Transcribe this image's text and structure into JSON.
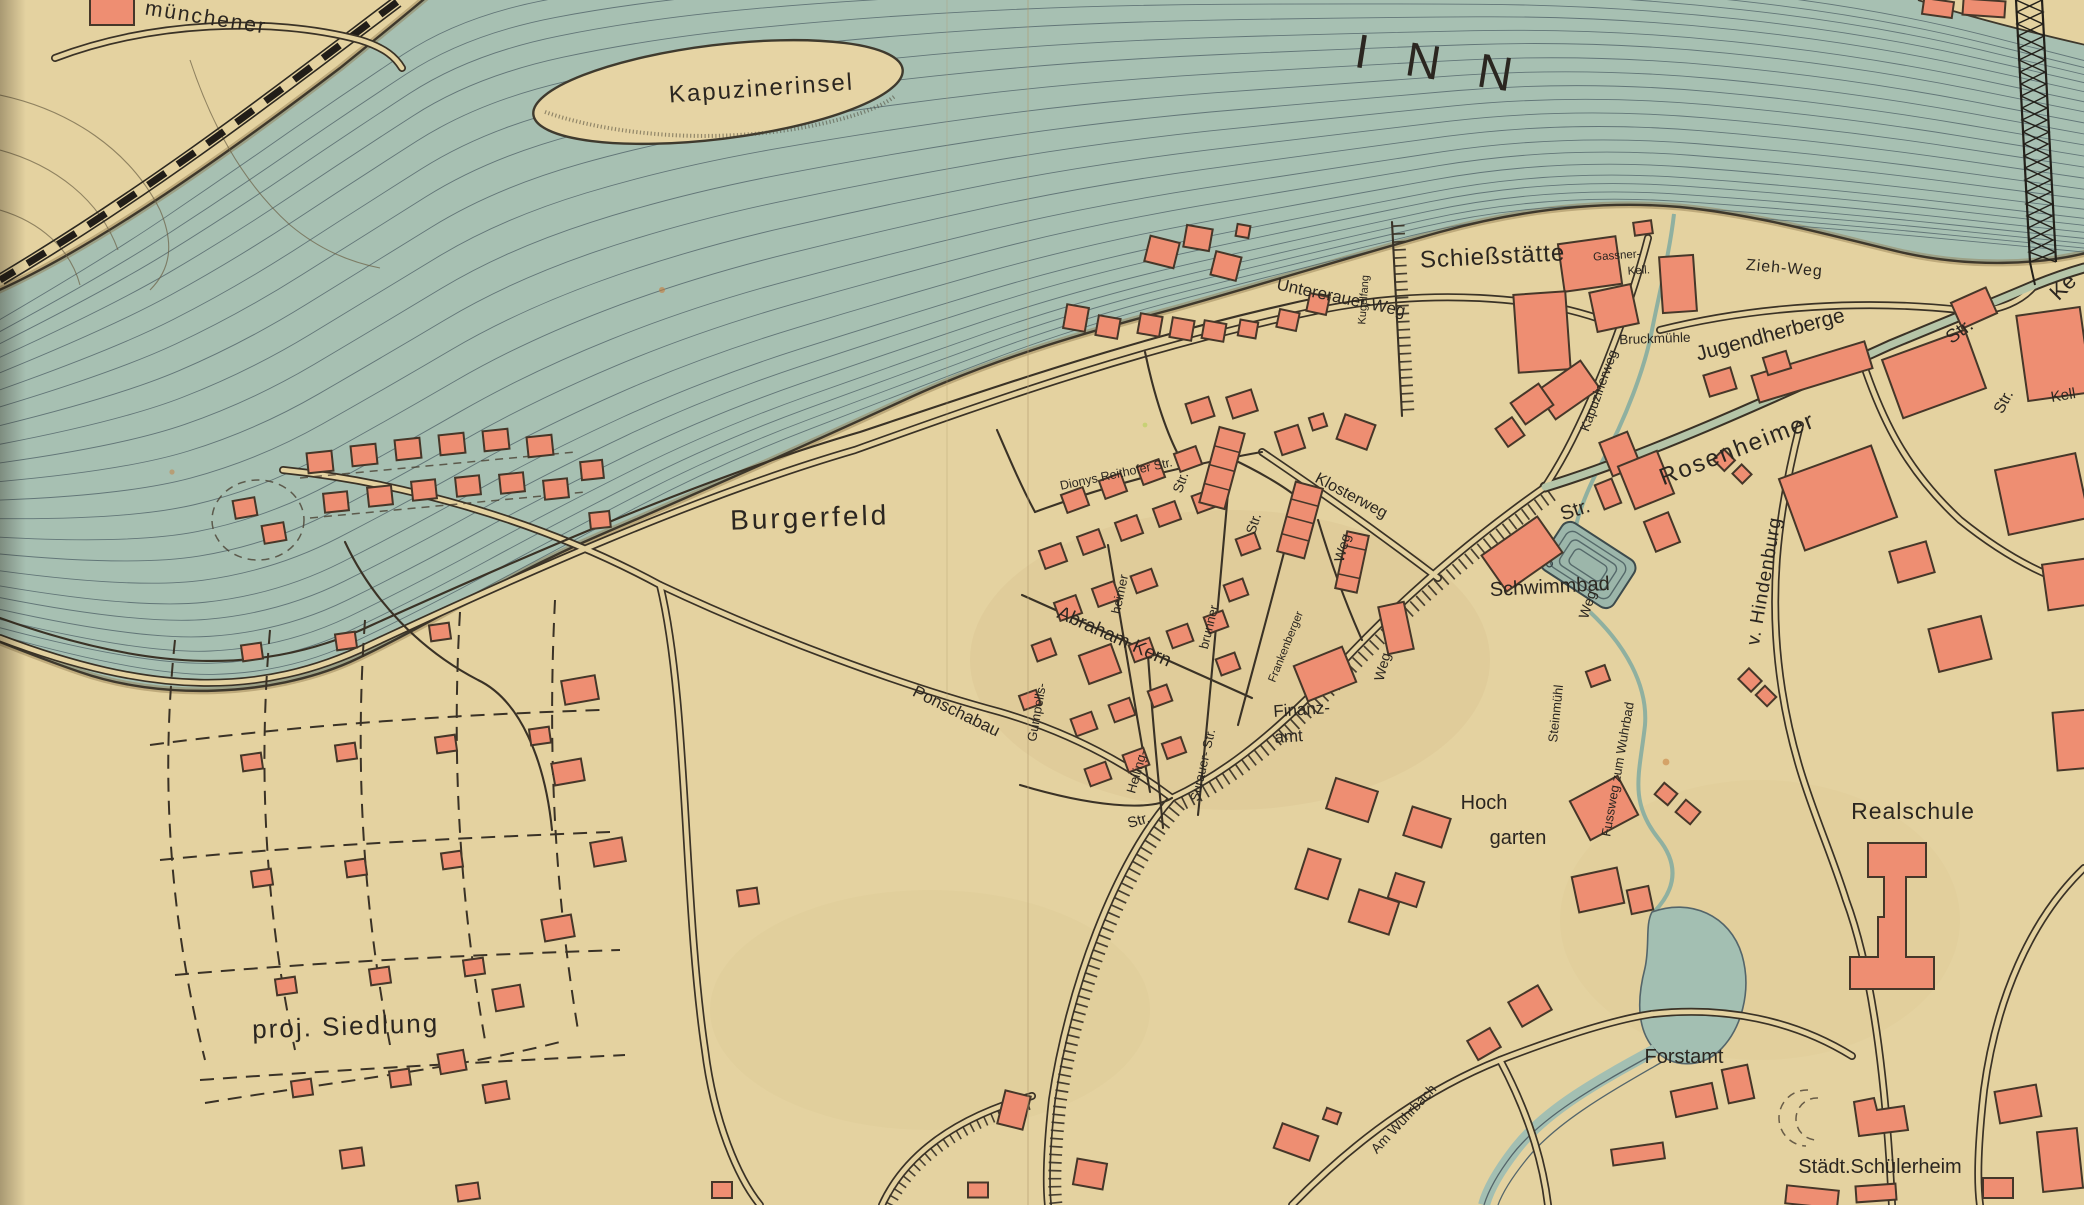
{
  "map_type": "historical town plan",
  "labels": {
    "river": "INN",
    "island": "Kapuzinerinsel",
    "muenchener": "münchener",
    "burgerfeld": "Burgerfeld",
    "proj_siedlung": "proj. Siedlung",
    "ponschabau": "Ponschabau",
    "untererauer_weg": "Untererauer-Weg",
    "kugelfang": "Kugelfang",
    "schiessstaette": "Schießstätte",
    "gassner_line1": "Gassner-",
    "gassner_line2": "Kell.",
    "bruckmuehle": "Bruckmühle",
    "zieh_weg": "Zieh-Weg",
    "jugendherberge": "Jugendherberge",
    "rosenheimer": "Rosenheimer",
    "str_rosenheimer": "Str.",
    "str_right_edge": "Str.",
    "ke_fragment": "Ke",
    "kell_fragment": "Kell",
    "kapuzinerweg": "Kapuzinerweg",
    "str_kapuzinerweg": "Str.",
    "schwimmbad": "Schwimmbad",
    "weg_pool": "Weg",
    "fussweg": "Fussweg zum Wuhrbad",
    "steinmuehl": "Steinmühl",
    "hindenburg": "v. Hindenburg",
    "realschule": "Realschule",
    "hoch": "Hoch",
    "garten": "garten",
    "forstamt": "Forstamt",
    "am_wuhrbach": "Am Wuhrbach",
    "schuelerheim": "Städt.Schülerheim",
    "dionys": "Dionys Reithofer Str.",
    "str_grid_top": "Str.",
    "klosterweg": "Klosterweg",
    "str_row": "Str.",
    "weg_row": "Weg",
    "weg_road": "Weg",
    "heimer": "heimer",
    "abraham_kern": "Abraham Kern",
    "brunner": "brunner",
    "frankenberger": "Frankenberger",
    "gumpells": "Gumpells-",
    "heiling": "Heiling-",
    "surauer": "Surauer- Str.",
    "str_grid_bottom": "Str.",
    "finanz": "Finanz-",
    "amt": "amt"
  },
  "colors": {
    "paper": "#e4d2a0",
    "river": "#a7c0b2",
    "flow_line": "#56696d",
    "building_fill": "#ee8e72",
    "building_stroke": "#463729",
    "road": "#3a3226",
    "water_edge": "#4f6258",
    "avenue_green": "#b5c5a8",
    "label": "#2b2620"
  }
}
